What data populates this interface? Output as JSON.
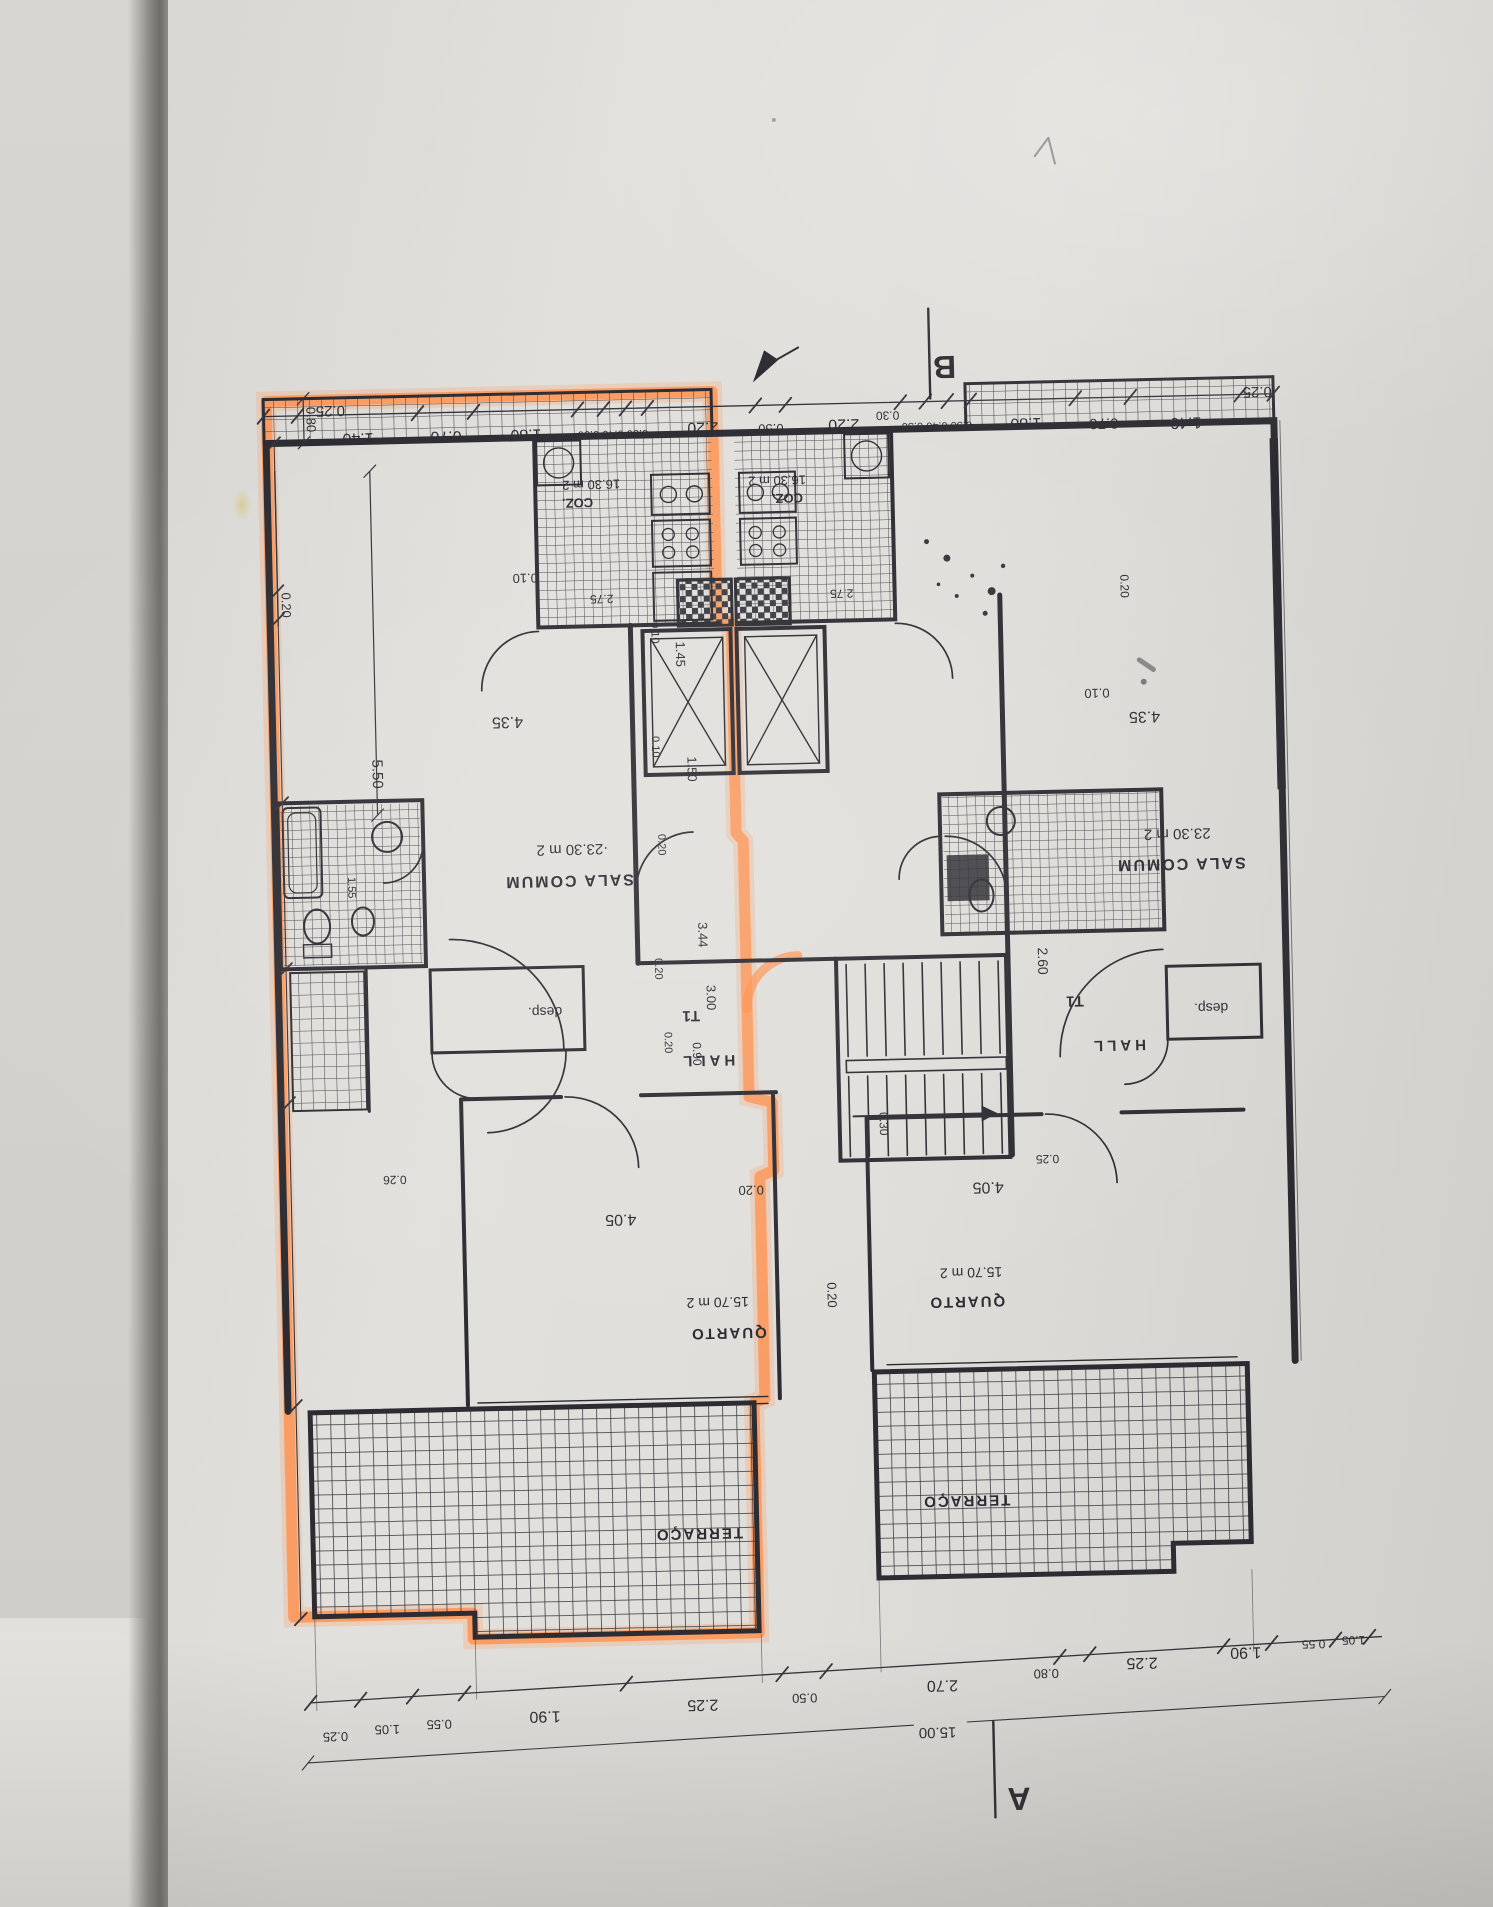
{
  "colors": {
    "highlight": "#ff8f4b",
    "ink": "#2b2b31",
    "paper": "#e0deda"
  },
  "plan": {
    "unit_left": {
      "rooms": [
        {
          "name": "SALA COMUM",
          "area": "23.30 m 2"
        },
        {
          "name": "COZ.",
          "area": "16.30 m 2"
        },
        {
          "name": "QUARTO",
          "area": "15.70 m 2"
        },
        {
          "name": "HALL",
          "type_tag": "T1"
        },
        {
          "name": "desp."
        },
        {
          "name": "TERRAÇO"
        }
      ],
      "highlighted": true
    },
    "unit_right": {
      "rooms": [
        {
          "name": "SALA COMUM",
          "area": "23.30 m 2"
        },
        {
          "name": "COZ.",
          "area": "16.30 m 2"
        },
        {
          "name": "QUARTO",
          "area": "15.70 m 2"
        },
        {
          "name": "HALL",
          "type_tag": "T1"
        },
        {
          "name": "desp."
        },
        {
          "name": "TERRAÇO"
        }
      ],
      "highlighted": false
    },
    "section_markers": [
      "A",
      "B"
    ],
    "overall_width": "15.00"
  },
  "annotations": [
    {
      "name": "dim-top-025-l",
      "t": "0.25",
      "x": 345,
      "y": 396,
      "s": 15,
      "r": 180
    },
    {
      "name": "dim-top-140-l",
      "t": "1.40",
      "x": 372,
      "y": 424,
      "s": 16,
      "r": 180
    },
    {
      "name": "dim-top-070-l",
      "t": "0.70",
      "x": 460,
      "y": 424,
      "s": 16,
      "r": 180
    },
    {
      "name": "dim-top-180-l",
      "t": "1.80",
      "x": 540,
      "y": 424,
      "s": 16,
      "r": 180
    },
    {
      "name": "dim-top-trio-l",
      "t": "0.50 0.40 0.50",
      "x": 627,
      "y": 427,
      "s": 11,
      "r": 180
    },
    {
      "name": "dim-top-220-l",
      "t": "2.20",
      "x": 717,
      "y": 421,
      "s": 16,
      "r": 180
    },
    {
      "name": "dim-top-050-c",
      "t": "0.50",
      "x": 785,
      "y": 424,
      "s": 13,
      "r": 180
    },
    {
      "name": "dim-top-220-r",
      "t": "2.20",
      "x": 858,
      "y": 421,
      "s": 16,
      "r": 180
    },
    {
      "name": "dim-top-trio-r",
      "t": "0.50 0.40 0.50",
      "x": 951,
      "y": 426,
      "s": 11,
      "r": 180
    },
    {
      "name": "dim-top-180-r",
      "t": "1.80",
      "x": 1040,
      "y": 424,
      "s": 16,
      "r": 180
    },
    {
      "name": "dim-top-070-r",
      "t": "0.70",
      "x": 1118,
      "y": 426,
      "s": 15,
      "r": 180
    },
    {
      "name": "dim-top-140-r",
      "t": "1.40",
      "x": 1200,
      "y": 427,
      "s": 16,
      "r": 180
    },
    {
      "name": "dim-top-025-r",
      "t": "0.25",
      "x": 1272,
      "y": 398,
      "s": 15,
      "r": 180
    },
    {
      "name": "dim-top-030",
      "t": "0.30",
      "x": 902,
      "y": 414,
      "s": 12,
      "r": 180
    },
    {
      "name": "dim-bot-025-l",
      "t": "0.25",
      "x": 320,
      "y": 1722,
      "s": 13,
      "r": 180
    },
    {
      "name": "dim-bot-105-l",
      "t": "1.05",
      "x": 372,
      "y": 1716,
      "s": 13,
      "r": 180
    },
    {
      "name": "dim-bot-055-l",
      "t": "0.55",
      "x": 424,
      "y": 1712,
      "s": 13,
      "r": 180
    },
    {
      "name": "dim-bot-190-l",
      "t": "1.90",
      "x": 530,
      "y": 1706,
      "s": 16,
      "r": 180
    },
    {
      "name": "dim-bot-225-l",
      "t": "2.25",
      "x": 688,
      "y": 1698,
      "s": 16,
      "r": 180
    },
    {
      "name": "dim-bot-050",
      "t": "0.50",
      "x": 790,
      "y": 1694,
      "s": 13,
      "r": 180
    },
    {
      "name": "dim-bot-270",
      "t": "2.70",
      "x": 928,
      "y": 1684,
      "s": 16,
      "r": 180
    },
    {
      "name": "dim-bot-080",
      "t": "0.80",
      "x": 1032,
      "y": 1675,
      "s": 13,
      "r": 180
    },
    {
      "name": "dim-bot-225-r",
      "t": "2.25",
      "x": 1128,
      "y": 1666,
      "s": 16,
      "r": 180
    },
    {
      "name": "dim-bot-190-r",
      "t": "1.90",
      "x": 1232,
      "y": 1658,
      "s": 16,
      "r": 180
    },
    {
      "name": "dim-bot-055-r",
      "t": "0.55",
      "x": 1300,
      "y": 1652,
      "s": 12,
      "r": 180
    },
    {
      "name": "dim-bot-105-r",
      "t": "1.05",
      "x": 1340,
      "y": 1649,
      "s": 12,
      "r": 180
    },
    {
      "name": "dim-bot-total",
      "t": "15.00",
      "x": 922,
      "y": 1731,
      "s": 15,
      "r": 180
    },
    {
      "name": "dim-v-080",
      "t": "0.80",
      "x": 321,
      "y": 409,
      "s": 13,
      "r": 90
    },
    {
      "name": "dim-v-020-wall-l",
      "t": "0.20",
      "x": 292,
      "y": 594,
      "s": 13,
      "r": 90
    },
    {
      "name": "dim-v-550",
      "t": "5.50",
      "x": 379,
      "y": 765,
      "s": 15,
      "r": 90
    },
    {
      "name": "dim-v-010-shaft",
      "t": "0.10",
      "x": 661,
      "y": 630,
      "s": 11,
      "r": 90
    },
    {
      "name": "dim-v-145",
      "t": "1.45",
      "x": 685,
      "y": 652,
      "s": 13,
      "r": 90
    },
    {
      "name": "dim-v-010-lobby",
      "t": "0.10",
      "x": 659,
      "y": 744,
      "s": 11,
      "r": 90
    },
    {
      "name": "dim-v-150",
      "t": "1.50",
      "x": 694,
      "y": 767,
      "s": 13,
      "r": 90
    },
    {
      "name": "dim-v-020-core1",
      "t": "0.20",
      "x": 663,
      "y": 842,
      "s": 11,
      "r": 90
    },
    {
      "name": "dim-v-344",
      "t": "3.44",
      "x": 701,
      "y": 933,
      "s": 13,
      "r": 90
    },
    {
      "name": "dim-v-020-core2",
      "t": "0.20",
      "x": 657,
      "y": 966,
      "s": 11,
      "r": 90
    },
    {
      "name": "dim-v-300",
      "t": "3.00",
      "x": 708,
      "y": 996,
      "s": 13,
      "r": 90
    },
    {
      "name": "dim-v-020-core3",
      "t": "0.20",
      "x": 665,
      "y": 1040,
      "s": 11,
      "r": 90
    },
    {
      "name": "dim-v-090",
      "t": "0.90",
      "x": 693,
      "y": 1052,
      "s": 12,
      "r": 90
    },
    {
      "name": "dim-v-260",
      "t": "2.60",
      "x": 1040,
      "y": 967,
      "s": 14,
      "r": 90
    },
    {
      "name": "dim-v-020-quarto-l",
      "t": "0.20",
      "x": 822,
      "y": 1296,
      "s": 13,
      "r": 90
    },
    {
      "name": "dim-v-030-quarto-r",
      "t": "0.30",
      "x": 878,
      "y": 1126,
      "s": 12,
      "r": 90
    },
    {
      "name": "dim-v-155-bath",
      "t": "1.55",
      "x": 352,
      "y": 878,
      "s": 11,
      "r": 90
    },
    {
      "name": "dim-v-020-wall-r",
      "t": "0.20",
      "x": 1131,
      "y": 594,
      "s": 12,
      "r": 90
    },
    {
      "name": "dim-h-010-l",
      "t": "0.10",
      "x": 536,
      "y": 568,
      "s": 13,
      "r": 180
    },
    {
      "name": "dim-h-435-l",
      "t": "4.35",
      "x": 515,
      "y": 711,
      "s": 16,
      "r": 180
    },
    {
      "name": "dim-h-275-l",
      "t": "2.75",
      "x": 612,
      "y": 591,
      "s": 12,
      "r": 180
    },
    {
      "name": "dim-h-275-r",
      "t": "2.75",
      "x": 852,
      "y": 591,
      "s": 12,
      "r": 180
    },
    {
      "name": "dim-h-010-r",
      "t": "0.10",
      "x": 1105,
      "y": 696,
      "s": 13,
      "r": 180
    },
    {
      "name": "dim-h-435-r",
      "t": "4.35",
      "x": 1152,
      "y": 720,
      "s": 16,
      "r": 180
    },
    {
      "name": "dim-h-405-l",
      "t": "4.05",
      "x": 617,
      "y": 1211,
      "s": 16,
      "r": 180
    },
    {
      "name": "dim-h-020-quarto",
      "t": "0.20",
      "x": 748,
      "y": 1185,
      "s": 13,
      "r": 180
    },
    {
      "name": "dim-h-405-r",
      "t": "4.05",
      "x": 985,
      "y": 1187,
      "s": 16,
      "r": 180
    },
    {
      "name": "dim-h-025-quarto-r",
      "t": "0.25",
      "x": 1045,
      "y": 1161,
      "s": 12,
      "r": 180
    },
    {
      "name": "dim-h-026-quarto-l",
      "t": "0.26",
      "x": 392,
      "y": 1167,
      "s": 12,
      "r": 180
    },
    {
      "name": "room-coz-area-left",
      "t": "16.30 m 2",
      "x": 604,
      "y": 476,
      "s": 13,
      "r": 180
    },
    {
      "name": "room-coz-left",
      "t": "COZ.",
      "x": 590,
      "y": 494,
      "s": 13,
      "r": 180,
      "w": 700
    },
    {
      "name": "room-coz-area-right",
      "t": "16.30 m 2",
      "x": 790,
      "y": 476,
      "s": 13,
      "r": 180
    },
    {
      "name": "room-coz-right",
      "t": "COZ.",
      "x": 800,
      "y": 494,
      "s": 13,
      "r": 180,
      "w": 700
    },
    {
      "name": "room-sala-area-left",
      "t": "·23.30 m 2",
      "x": 577,
      "y": 840,
      "s": 15,
      "r": 180
    },
    {
      "name": "room-sala-left",
      "t": "SALA COMUM",
      "x": 573,
      "y": 871,
      "s": 16,
      "r": 180,
      "ls": 2,
      "w": 700
    },
    {
      "name": "room-sala-area-right",
      "t": "23.30 m 2",
      "x": 1182,
      "y": 838,
      "s": 15,
      "r": 180
    },
    {
      "name": "room-sala-right",
      "t": "SALA COMUM",
      "x": 1185,
      "y": 868,
      "s": 16,
      "r": 180,
      "ls": 2,
      "w": 700
    },
    {
      "name": "label-t1-left",
      "t": "T1",
      "x": 692,
      "y": 1009,
      "s": 15,
      "r": 180,
      "w": 700
    },
    {
      "name": "room-hall-left",
      "t": "HALL",
      "x": 707,
      "y": 1054,
      "s": 15,
      "r": 180,
      "ls": 4,
      "w": 700
    },
    {
      "name": "label-t1-right",
      "t": "T1",
      "x": 1076,
      "y": 1003,
      "s": 15,
      "r": 180,
      "w": 700
    },
    {
      "name": "room-hall-right",
      "t": "HALL",
      "x": 1118,
      "y": 1048,
      "s": 15,
      "r": 180,
      "ls": 4,
      "w": 700
    },
    {
      "name": "room-desp-left",
      "t": "desp.",
      "x": 546,
      "y": 1002,
      "s": 14,
      "r": 180
    },
    {
      "name": "room-desp-right",
      "t": "desp.",
      "x": 1212,
      "y": 1013,
      "s": 14,
      "r": 180
    },
    {
      "name": "room-quarto-area-left",
      "t": "15.70 m 2",
      "x": 712,
      "y": 1296,
      "s": 14,
      "r": 180
    },
    {
      "name": "room-quarto-left",
      "t": "QUARTO",
      "x": 722,
      "y": 1327,
      "s": 15,
      "r": 180,
      "ls": 2,
      "w": 700
    },
    {
      "name": "room-quarto-area-right",
      "t": "15.70 m 2",
      "x": 966,
      "y": 1272,
      "s": 14,
      "r": 180
    },
    {
      "name": "room-quarto-right",
      "t": "QUARTO",
      "x": 961,
      "y": 1301,
      "s": 15,
      "r": 180,
      "ls": 2,
      "w": 700
    },
    {
      "name": "room-terraco-left",
      "t": "TERRAÇO",
      "x": 688,
      "y": 1527,
      "s": 15,
      "r": 180,
      "ls": 2,
      "w": 700
    },
    {
      "name": "room-terraco-right",
      "t": "TERRAÇO",
      "x": 956,
      "y": 1500,
      "s": 15,
      "r": 180,
      "ls": 2,
      "w": 700
    },
    {
      "name": "section-marker-b",
      "t": "B",
      "x": 960,
      "y": 360,
      "s": 32,
      "r": 180,
      "w": 700
    },
    {
      "name": "section-marker-a",
      "t": "A",
      "x": 1002,
      "y": 1793,
      "s": 32,
      "r": 180,
      "w": 700
    }
  ]
}
